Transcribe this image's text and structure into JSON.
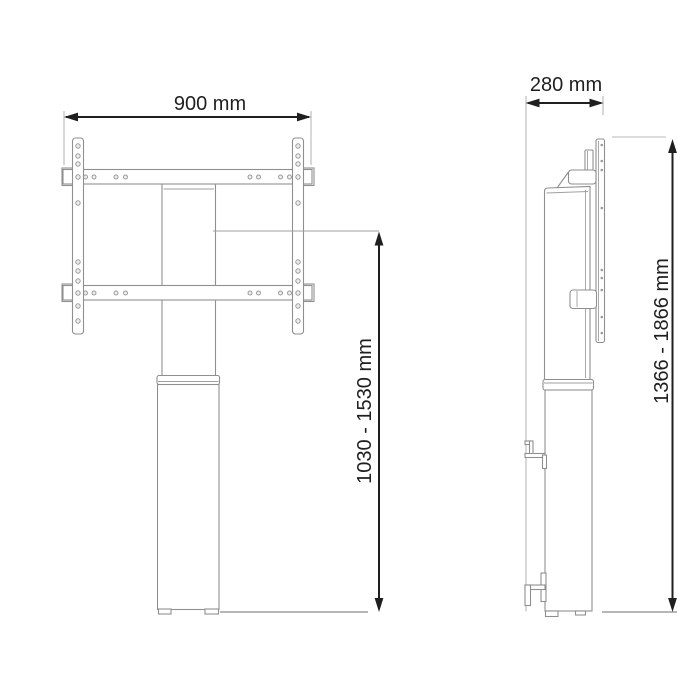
{
  "figure": {
    "type": "technical-drawing",
    "description": "Height adjustable display stand, front view and side view with dimensions",
    "views": {
      "front": {
        "name": "front-view",
        "width_dimension": "900 mm",
        "height_dimension": "1030 - 1530 mm"
      },
      "side": {
        "name": "side-view",
        "depth_dimension": "280 mm",
        "height_dimension": "1366 - 1866 mm"
      }
    },
    "colors": {
      "dimension_lines": "#1f1f1f",
      "outline": "#8f8f8f",
      "background": "#ffffff"
    }
  }
}
